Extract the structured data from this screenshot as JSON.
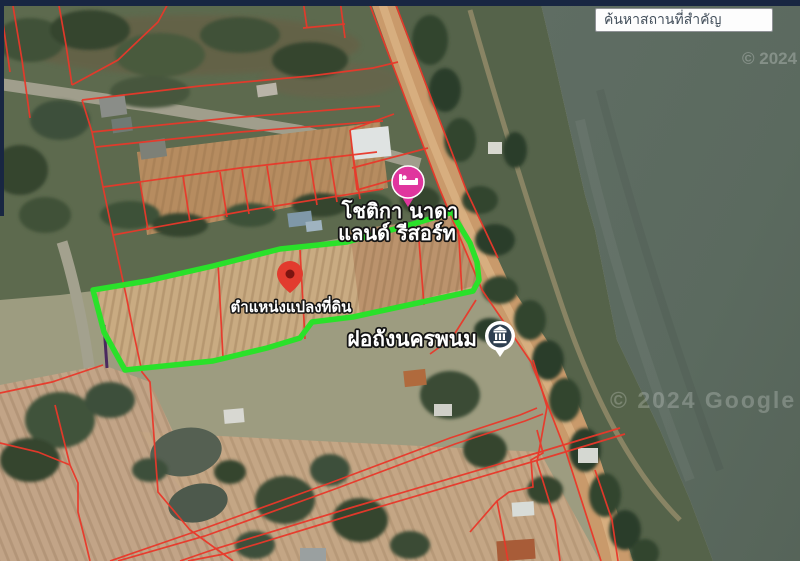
{
  "search": {
    "placeholder": "ค้นหาสถานที่สำคัญ"
  },
  "chrome": {
    "top_bar_color": "#182642"
  },
  "map": {
    "labels": {
      "resort_line1": "โชติกา นาดา",
      "resort_line2": "แลนด์ รีสอร์ท",
      "plot_location": "ตำแหน่งแปลงที่ดิน",
      "water_tower": "ฝอถังนครพนม"
    },
    "markers": {
      "resort": {
        "type": "lodging",
        "color": "#e0369e"
      },
      "plot_pin": {
        "type": "pin",
        "color": "#e23b2e",
        "dot_color": "#7c1410"
      },
      "water_tower": {
        "type": "landmark",
        "color": "#ffffff",
        "badge_color": "#2e3f50"
      }
    },
    "watermarks": {
      "top_right": "© 2024",
      "bottom": "© 2024 Google"
    },
    "overlay": {
      "plot_outline_color": "#2ae12a",
      "cadastral_line_color": "#e9382a"
    }
  }
}
